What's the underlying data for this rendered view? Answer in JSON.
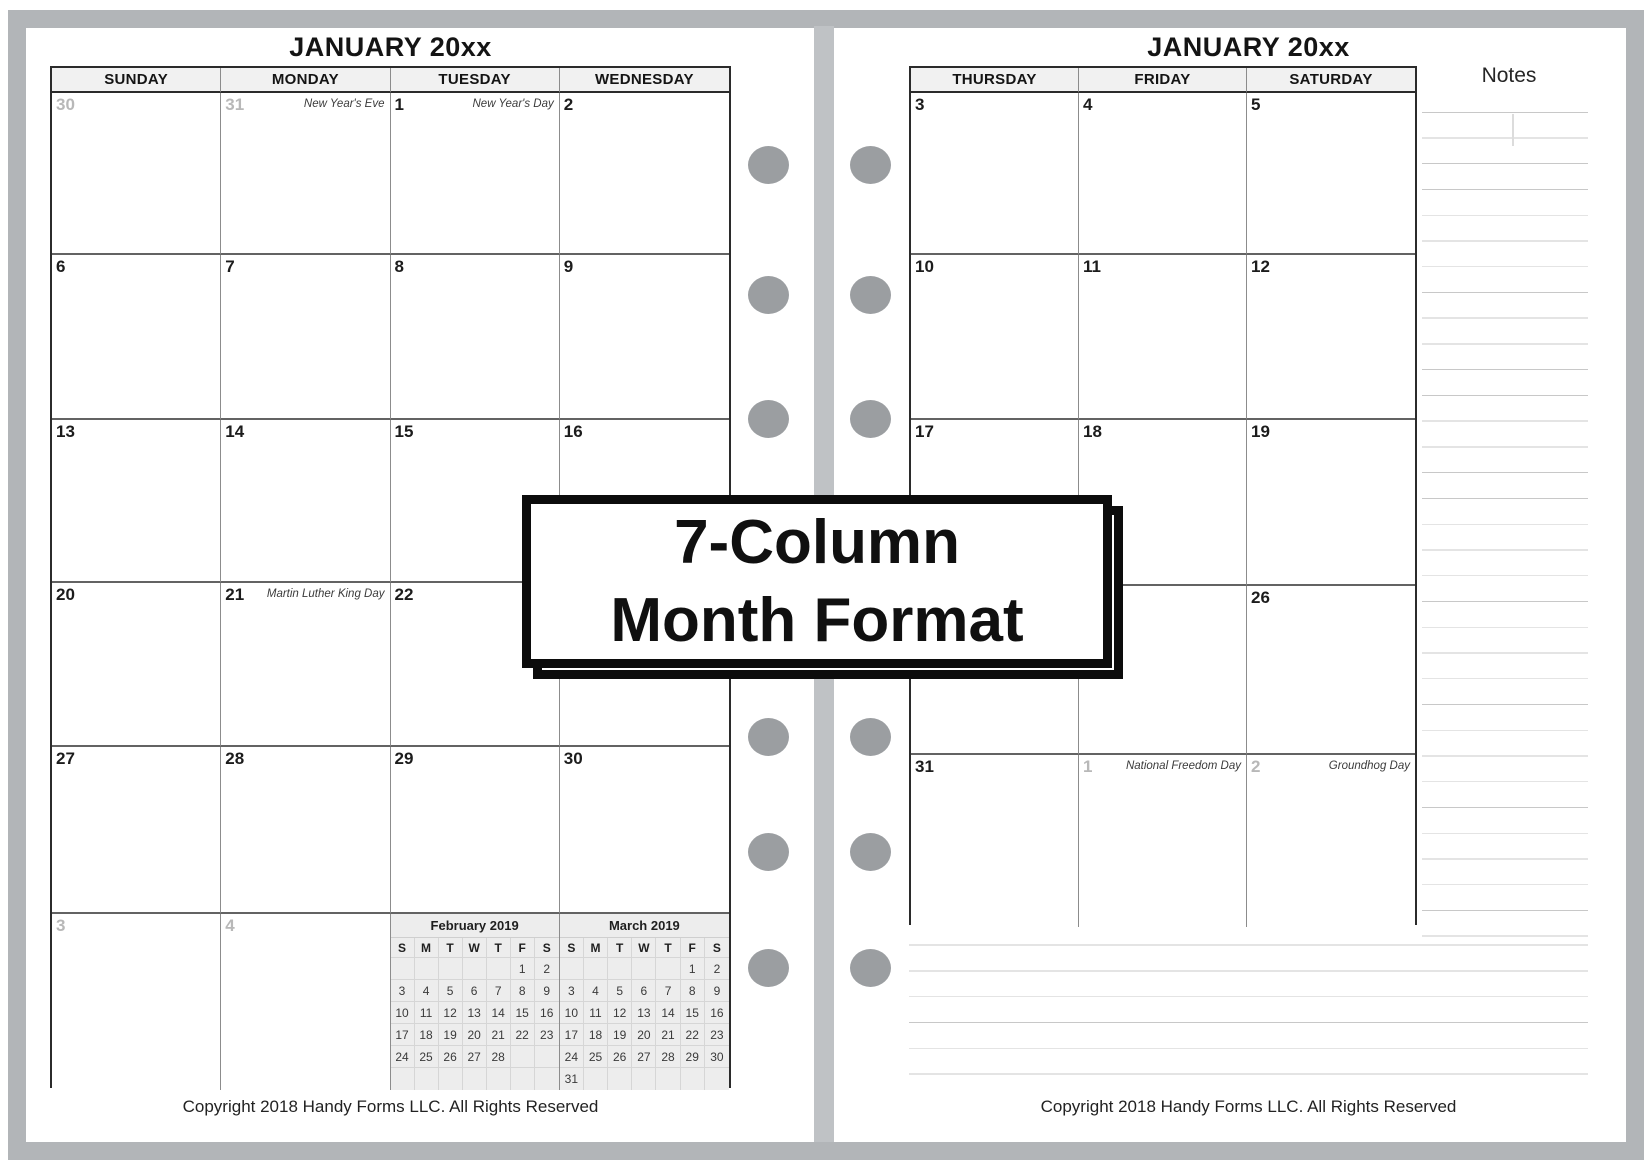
{
  "banner": {
    "line1": "7-Column",
    "line2": "Month Format"
  },
  "pages": {
    "left": {
      "title": "JANUARY 20xx",
      "day_headers": [
        "SUNDAY",
        "MONDAY",
        "TUESDAY",
        "WEDNESDAY"
      ],
      "weeks": [
        [
          {
            "n": "30",
            "muted": true
          },
          {
            "n": "31",
            "muted": true,
            "holiday": "New Year's Eve"
          },
          {
            "n": "1",
            "holiday": "New Year's Day"
          },
          {
            "n": "2"
          }
        ],
        [
          {
            "n": "6"
          },
          {
            "n": "7"
          },
          {
            "n": "8"
          },
          {
            "n": "9"
          }
        ],
        [
          {
            "n": "13"
          },
          {
            "n": "14"
          },
          {
            "n": "15"
          },
          {
            "n": "16"
          }
        ],
        [
          {
            "n": "20"
          },
          {
            "n": "21",
            "holiday": "Martin Luther King Day"
          },
          {
            "n": "22"
          },
          {
            "n": ""
          }
        ],
        [
          {
            "n": "27"
          },
          {
            "n": "28"
          },
          {
            "n": "29"
          },
          {
            "n": "30"
          }
        ],
        [
          {
            "n": "3",
            "muted": true
          },
          {
            "n": "4",
            "muted": true
          },
          {
            "mini": 0
          },
          {
            "mini": 1
          }
        ]
      ],
      "mini_calendars": [
        {
          "title": "February 2019",
          "day_headers": [
            "S",
            "M",
            "T",
            "W",
            "T",
            "F",
            "S"
          ],
          "rows": [
            [
              "",
              "",
              "",
              "",
              "",
              "1",
              "2"
            ],
            [
              "3",
              "4",
              "5",
              "6",
              "7",
              "8",
              "9"
            ],
            [
              "10",
              "11",
              "12",
              "13",
              "14",
              "15",
              "16"
            ],
            [
              "17",
              "18",
              "19",
              "20",
              "21",
              "22",
              "23"
            ],
            [
              "24",
              "25",
              "26",
              "27",
              "28",
              "",
              ""
            ],
            [
              "",
              "",
              "",
              "",
              "",
              "",
              ""
            ]
          ]
        },
        {
          "title": "March 2019",
          "day_headers": [
            "S",
            "M",
            "T",
            "W",
            "T",
            "F",
            "S"
          ],
          "rows": [
            [
              "",
              "",
              "",
              "",
              "",
              "1",
              "2"
            ],
            [
              "3",
              "4",
              "5",
              "6",
              "7",
              "8",
              "9"
            ],
            [
              "10",
              "11",
              "12",
              "13",
              "14",
              "15",
              "16"
            ],
            [
              "17",
              "18",
              "19",
              "20",
              "21",
              "22",
              "23"
            ],
            [
              "24",
              "25",
              "26",
              "27",
              "28",
              "29",
              "30"
            ],
            [
              "31",
              "",
              "",
              "",
              "",
              "",
              ""
            ]
          ]
        }
      ],
      "copyright": "Copyright 2018 Handy Forms LLC. All Rights Reserved"
    },
    "right": {
      "title": "JANUARY 20xx",
      "day_headers": [
        "THURSDAY",
        "FRIDAY",
        "SATURDAY"
      ],
      "notes_label": "Notes",
      "weeks": [
        [
          {
            "n": "3"
          },
          {
            "n": "4"
          },
          {
            "n": "5"
          }
        ],
        [
          {
            "n": "10"
          },
          {
            "n": "11"
          },
          {
            "n": "12"
          }
        ],
        [
          {
            "n": "17"
          },
          {
            "n": "18"
          },
          {
            "n": "19"
          }
        ],
        [
          {
            "n": ""
          },
          {
            "n": ""
          },
          {
            "n": "26"
          }
        ],
        [
          {
            "n": "31"
          },
          {
            "n": "1",
            "muted": true,
            "holiday": "National Freedom Day"
          },
          {
            "n": "2",
            "muted": true,
            "holiday": "Groundhog Day"
          }
        ]
      ],
      "copyright": "Copyright 2018 Handy Forms LLC. All Rights Reserved"
    }
  },
  "colors": {
    "frame_gray": "#b2b5b8",
    "spine_gray": "#bfc2c5",
    "hole_gray": "#9b9ea1",
    "header_bg": "#f1f1f1",
    "muted_date": "#b8b8b8",
    "rule_line": "#c8c8c8",
    "banner_border": "#0c0c0c"
  }
}
